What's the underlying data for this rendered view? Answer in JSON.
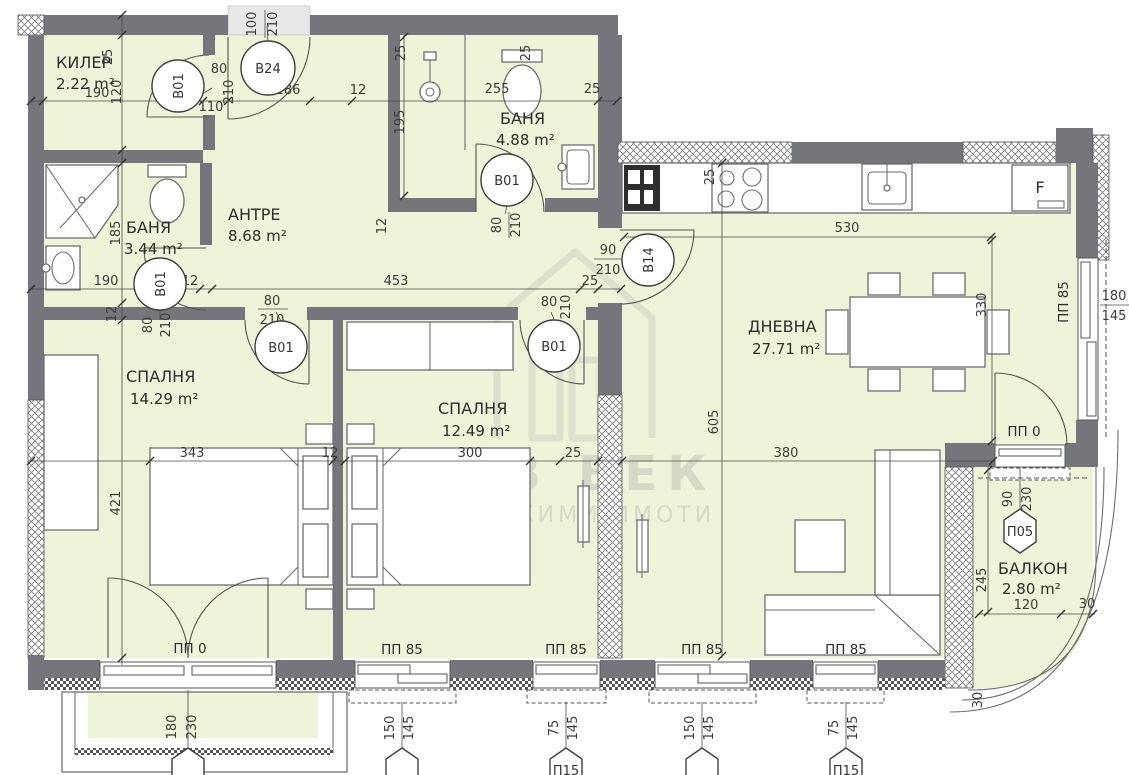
{
  "watermark": {
    "title": "НОВ ВЕК",
    "subtitle": "НЕДВИЖИМИ ИМОТИ"
  },
  "rooms": [
    {
      "name": "КИЛЕР",
      "area": "2.22 m²"
    },
    {
      "name": "БАНЯ",
      "area": "3.44 m²"
    },
    {
      "name": "АНТРЕ",
      "area": "8.68 m²"
    },
    {
      "name": "БАНЯ",
      "area": "4.88 m²"
    },
    {
      "name": "СПАЛНЯ",
      "area": "14.29 m²"
    },
    {
      "name": "СПАЛНЯ",
      "area": "12.49 m²"
    },
    {
      "name": "ДНЕВНА",
      "area": "27.71 m²"
    },
    {
      "name": "БАЛКОН",
      "area": "2.80 m²"
    }
  ],
  "tags": {
    "b01": "B01",
    "b24": "B24",
    "b14": "B14",
    "pp85": "ПП 85",
    "pp0": "ПП 0",
    "p05": "П05",
    "p15": "П15",
    "fridge": "F"
  },
  "dims": [
    "190",
    "120",
    "25",
    "12",
    "110",
    "80",
    "210",
    "186",
    "12",
    "100",
    "210",
    "25",
    "25",
    "255",
    "25",
    "195",
    "12",
    "80",
    "210",
    "185",
    "190",
    "12",
    "80",
    "210",
    "453",
    "25",
    "80",
    "210",
    "90",
    "210",
    "80",
    "210",
    "12",
    "421",
    "343",
    "12",
    "300",
    "25",
    "380",
    "605",
    "530",
    "25",
    "330",
    "180",
    "145",
    "90",
    "230",
    "245",
    "120",
    "30",
    "30",
    "180",
    "230",
    "150",
    "145",
    "75",
    "145",
    "150",
    "145",
    "75",
    "145"
  ],
  "colors": {
    "room_fill": "#eef4d7",
    "wall": "#75767b",
    "watermark": "#c4c9be"
  }
}
